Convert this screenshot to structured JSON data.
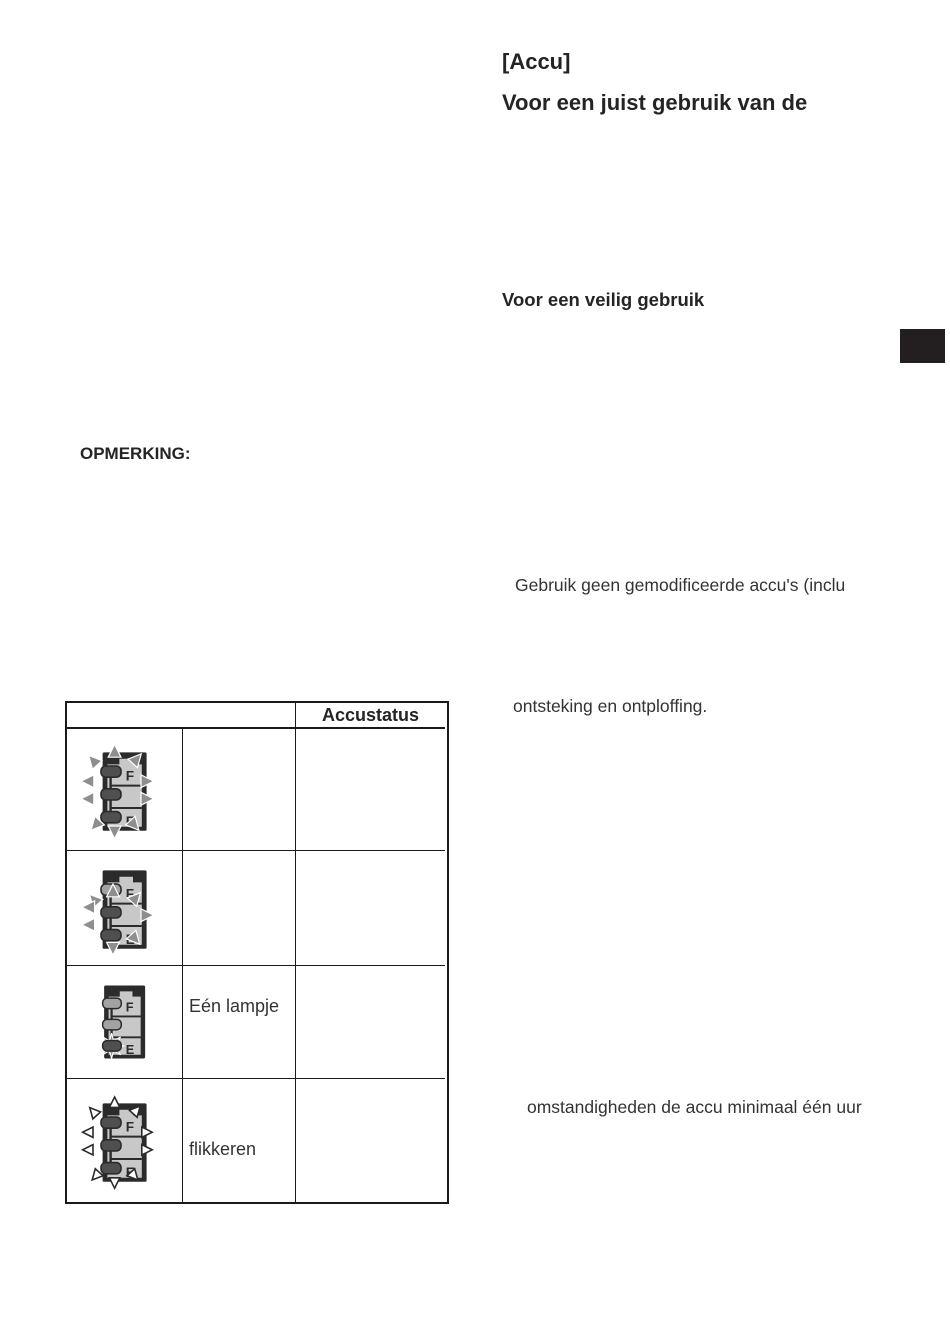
{
  "right_column": {
    "title_bracket": "[Accu]",
    "title": "Voor een juist gebruik van de",
    "section_heading": "Voor een veilig gebruik",
    "paragraph_fragment_1": "Gebruik geen gemodificeerde accu's (inclu",
    "paragraph_fragment_2": "ontsteking en ontploffing.",
    "paragraph_fragment_3": "omstandigheden de accu minimaal één uur"
  },
  "left_column": {
    "note_label": "OPMERKING:"
  },
  "battery_table": {
    "header": {
      "status_column": "Accustatus"
    },
    "letters": {
      "full": "F",
      "empty": "E"
    },
    "rows": [
      {
        "icon": "battery-all-lamps-flashing-icon",
        "description": "",
        "status": ""
      },
      {
        "icon": "battery-two-lamps-flashing-icon",
        "description": "",
        "status": ""
      },
      {
        "icon": "battery-one-lamp-flashing-icon",
        "description": "Eén lampje",
        "status": ""
      },
      {
        "icon": "battery-lamps-flickering-icon",
        "description": "flikkeren",
        "status": ""
      }
    ]
  },
  "colors": {
    "side_tab": "#231f20",
    "table_border": "#1a1a1a",
    "battery_case": "#2b2b2b",
    "battery_panel": "#c8c8c8",
    "lamp_lit": "#4f4f4f",
    "lamp_unlit": "#a2a2a2",
    "ray": "#8e8e8e"
  }
}
